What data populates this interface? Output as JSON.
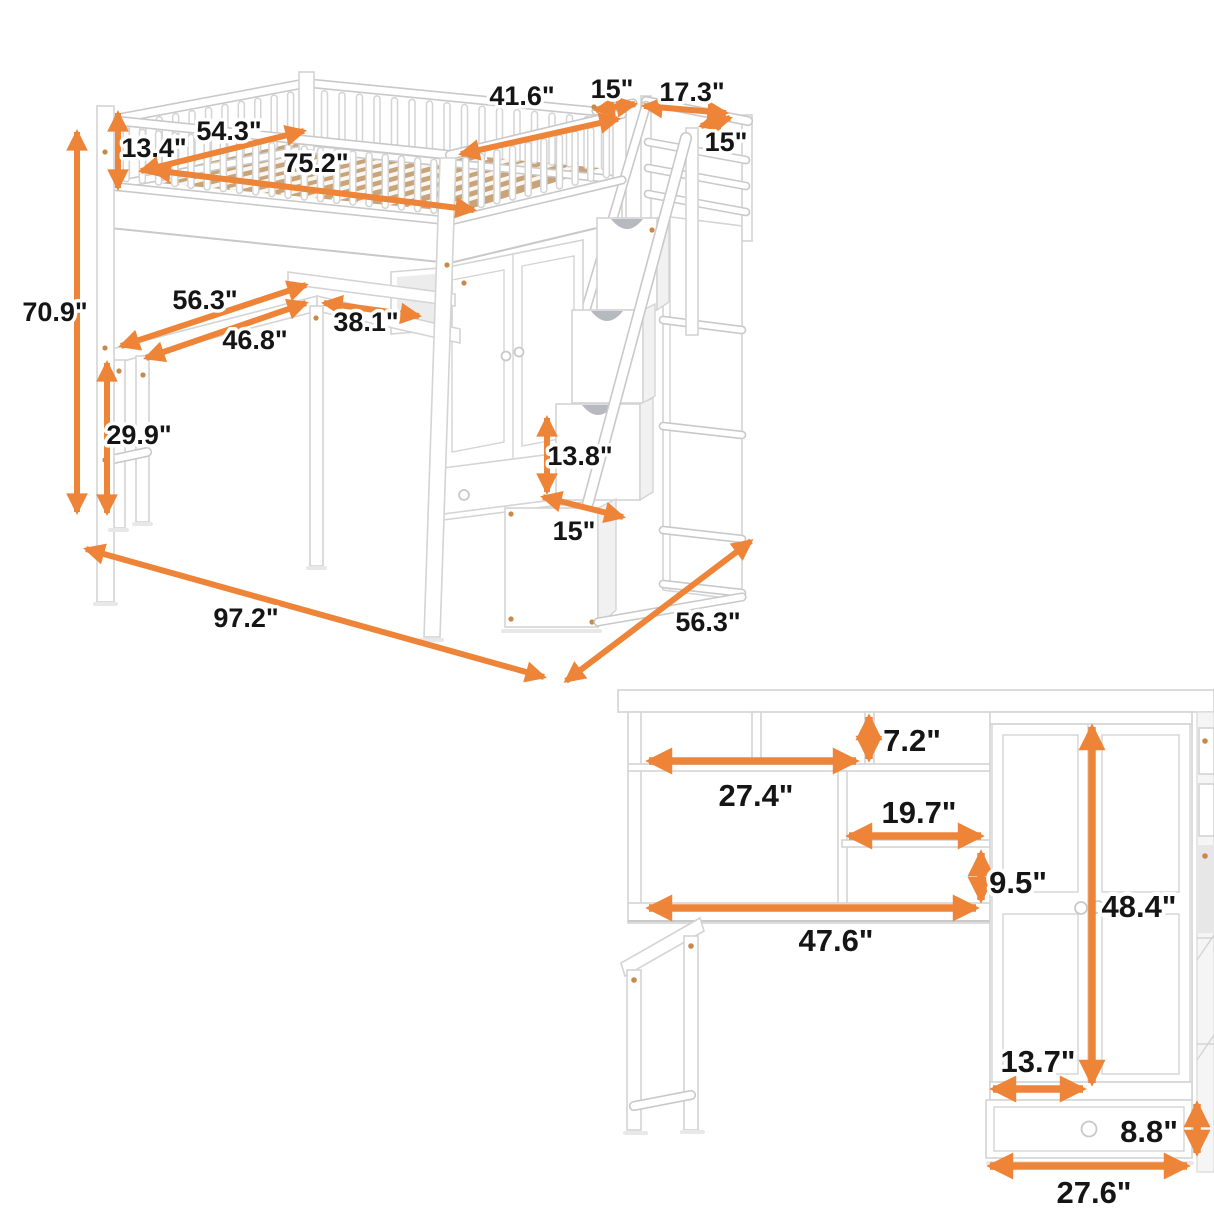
{
  "palette": {
    "arrow": "#ED8438",
    "text": "#151515",
    "outline": "#d4d4d4",
    "outline2": "#c9c9c9",
    "wood": "#C9A478",
    "shadow": "#e8e8e8",
    "cutout": "#a9aeb4",
    "screw": "#c8894a"
  },
  "main_view": {
    "name": "loft bed with desk, wardrobe and storage staircase - overall dimensions",
    "dimensions": {
      "overall_height": "70.9\"",
      "guardrail_height": "13.4\"",
      "bed_inner_width": "54.3\"",
      "bed_inner_length": "75.2\"",
      "right_rail_length": "41.6\"",
      "landing_gap": "15\"",
      "stair_landing_width": "17.3\"",
      "landing_depth": "15\"",
      "shelf_length": "56.3\"",
      "desk_length": "46.8\"",
      "desk_return_depth": "38.1\"",
      "desk_height": "29.9\"",
      "stair_drawer_height": "13.8\"",
      "stair_drawer_width": "15\"",
      "overall_length": "97.2\"",
      "overall_depth": "56.3\""
    }
  },
  "detail_view": {
    "name": "desk hutch and wardrobe - detail dimensions",
    "dimensions": {
      "top_cubby_height": "7.2\"",
      "hutch_shelf_width": "27.4\"",
      "middle_shelf_width": "19.7\"",
      "lower_cubby_height": "9.5\"",
      "desk_width": "47.6\"",
      "wardrobe_height": "48.4\"",
      "door_width": "13.7\"",
      "drawer_height": "8.8\"",
      "drawer_width": "27.6\""
    }
  }
}
